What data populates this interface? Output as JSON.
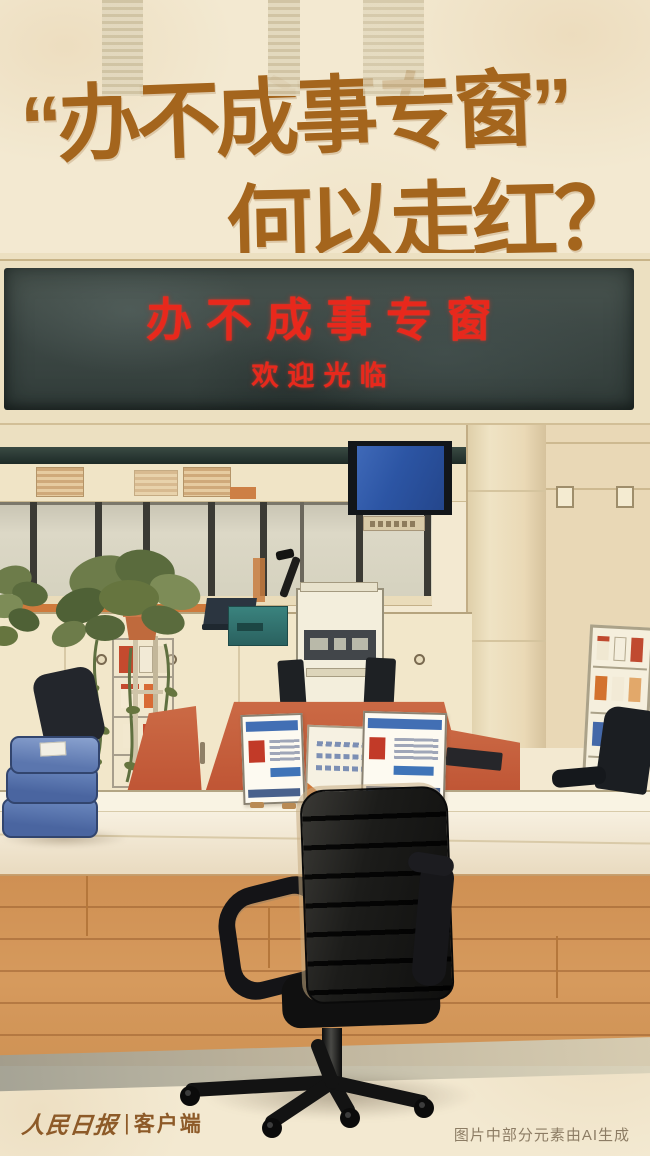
{
  "title": {
    "line1": "“办不成事专窗”",
    "line2": "何以走红？",
    "color": "#a4651d"
  },
  "led_sign": {
    "line1": "办不成事专窗",
    "line2": "欢迎光临",
    "text_color": "#e8281c",
    "board_color": "#3d4845"
  },
  "footer": {
    "brand": "人民日报",
    "divider": "|",
    "channel": "客户端",
    "ai_note": "图片中部分元素由AI生成"
  },
  "palette": {
    "background": "#f3e9d1",
    "title_brown": "#a4651d",
    "led_red": "#e8281c",
    "sign_board_dark": "#3d4845",
    "desk_red": "#c2583a",
    "counter_cream": "#f7f0e0",
    "floor_wood": "#d19255",
    "chair_black": "#17171a",
    "books_blue": "#5b7ab8",
    "banner_blue": "#3a64b4",
    "plant_green": "#6d7c4a",
    "teal_box": "#2f6b68",
    "logo_brown": "#8d5a28",
    "note_grey": "#8c7c64"
  }
}
